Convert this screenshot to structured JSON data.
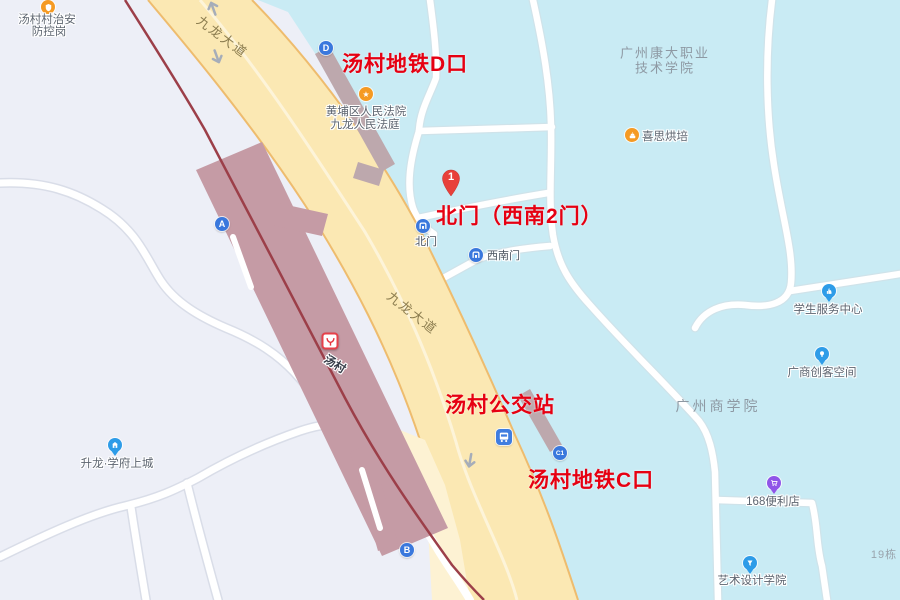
{
  "annotations": {
    "exit_d": "汤村地铁D口",
    "north_gate": "北门（西南2门）",
    "bus_stop": "汤村公交站",
    "exit_c": "汤村地铁C口",
    "marker1": "1"
  },
  "metro": {
    "station_label": "汤村",
    "exit_a": "A",
    "exit_b": "B",
    "exit_c1": "C1",
    "exit_d": "D"
  },
  "roads": {
    "kowloon_avenue": "九龙大道"
  },
  "gates": {
    "north": "北门",
    "southwest": "西南门"
  },
  "pois": {
    "security_line1": "汤村村治安",
    "security_line2": "防控岗",
    "court_line1": "黄埔区人民法院",
    "court_line2": "九龙人民法庭",
    "court_badge": "★",
    "bakery": "喜思烘培",
    "student_service": "学生服务中心",
    "maker_space": "广商创客空间",
    "store168": "168便利店",
    "art_school": "艺术设计学院",
    "shenglong": "升龙·学府上城"
  },
  "areas": {
    "kangda_line1": "广州康大职业",
    "kangda_line2": "技术学院",
    "business_college": "广州商学院",
    "building19": "19栋"
  },
  "colors": {
    "annotation_red": "#e60012",
    "campus_cyan": "#c9ebf4",
    "road_yellow": "#fbe8b3",
    "road_curb": "#eebc6e",
    "platform_mauve": "#c59ba5",
    "metro_line_red": "#9c3f49",
    "exit_blue": "#3a78dd",
    "poi_orange": "#f59a23",
    "pin_blue": "#2e9ce8",
    "pin_purple": "#9055e8"
  }
}
